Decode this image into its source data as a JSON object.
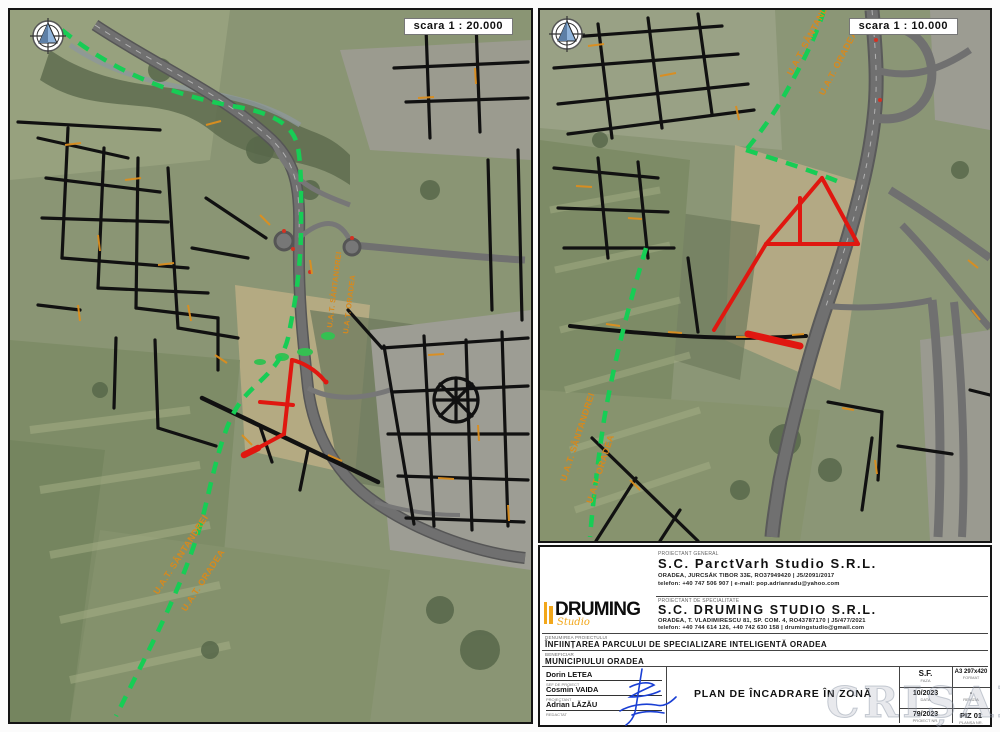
{
  "panels": {
    "left": {
      "scale_label": "scara 1 : 20.000"
    },
    "right": {
      "scale_label": "scara 1 : 10.000"
    }
  },
  "map_labels": {
    "uat_santandrei": "U.A.T. SÂNTANDREI",
    "uat_oradea": "U.A.T. ORADEA"
  },
  "title_block": {
    "general_designer": {
      "role_label": "PROIECTANT GENERAL",
      "name": "S.C. ParctVarh Studio S.R.L.",
      "address": "ORADEA, JURCSÁK TIBOR 33E, RO37949420 | J5/2091/2017",
      "contact": "telefon: +40 747 506 907 | e-mail: pop.adrianradu@yahoo.com"
    },
    "specialty_designer": {
      "role_label": "PROIECTANT DE SPECIALITATE",
      "name": "S.C. DRUMING STUDIO S.R.L.",
      "address": "ORADEA, T. VLADIMIRESCU 81, SP. COM. 4, RO43787170 | J5/477/2021",
      "contact": "telefon: +40 744 614 126, +40 742 630 158 | drumingstudio@gmail.com",
      "logo_text": "DRUMING",
      "logo_sub": "Studio"
    },
    "project": {
      "label": "DENUMIREA PROIECTULUI",
      "value": "ÎNFIINȚAREA PARCULUI DE SPECIALIZARE INTELIGENTĂ ORADEA"
    },
    "beneficiary": {
      "label": "BENEFICIAR",
      "value": "MUNICIPIULUI ORADEA"
    },
    "team": [
      {
        "name": "Dorin LETEA",
        "role": "ȘEF DE PROIECT"
      },
      {
        "name": "Cosmin VAIDA",
        "role": "PROIECTANT"
      },
      {
        "name": "Adrian LĂZĂU",
        "role": "REDACTAT"
      }
    ],
    "drawing_title": "PLAN DE ÎNCADRARE ÎN ZONĂ",
    "meta": {
      "phase": {
        "value": "S.F.",
        "label": "FAZA"
      },
      "date": {
        "value": "10/2023",
        "label": "DATA"
      },
      "project_no": {
        "value": "79/2023",
        "label": "PROIECT NR."
      },
      "format": {
        "value": "A3 297x420",
        "label": "FORMAT"
      },
      "revision": {
        "value": "-",
        "label": "REVIZIA"
      },
      "sheet_no": {
        "value": "PIZ 01",
        "label": "PLANȘA NR."
      }
    }
  },
  "watermark": "CRIȘANA",
  "colors": {
    "boundary_green": "#17cd55",
    "proposed_red": "#e01710",
    "label_orange": "#d8891c",
    "logo_yellow": "#f2a71b"
  }
}
